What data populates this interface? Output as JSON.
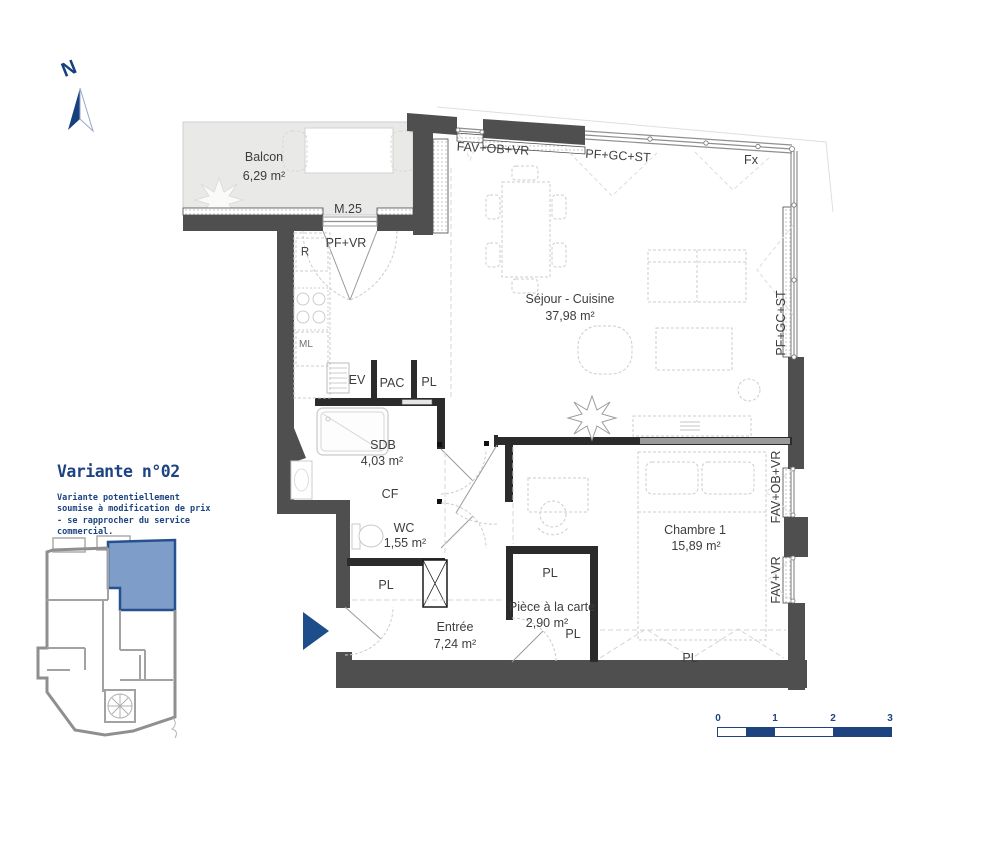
{
  "north": {
    "label": "N"
  },
  "variant": {
    "title": "Variante n°02",
    "disclaimer": "Variante potentiellement soumise à modification de prix - se rapprocher du service commercial."
  },
  "rooms": {
    "balcon": {
      "name": "Balcon",
      "area": "6,29 m²"
    },
    "sejour": {
      "name": "Séjour - Cuisine",
      "area": "37,98 m²"
    },
    "chambre1": {
      "name": "Chambre 1",
      "area": "15,89 m²"
    },
    "sdb": {
      "name": "SDB",
      "area": "4,03 m²"
    },
    "wc": {
      "name": "WC",
      "area": "1,55 m²"
    },
    "entree": {
      "name": "Entrée",
      "area": "7,24 m²"
    },
    "piece": {
      "name": "Pièce à la carte",
      "area": "2,90 m²"
    }
  },
  "annotations": {
    "m25": "M.25",
    "pf_vr": "PF+VR",
    "r": "R",
    "ml": "ML",
    "ev": "EV",
    "pac": "PAC",
    "pl_kitchen": "PL",
    "cf": "CF",
    "pl_wc": "PL",
    "pl_piece_top": "PL",
    "pl_piece_bottom": "PL",
    "pl_chambre": "PL",
    "fav_ob_vr_top": "FAV+OB+VR",
    "pf_gc_st_top": "PF+GC+ST",
    "fx": "Fx",
    "pf_gc_st_right": "PF+GC+ST",
    "fav_ob_vr_right": "FAV+OB+VR",
    "fav_vr_right": "FAV+VR"
  },
  "scale_bar": {
    "ticks": [
      "0",
      "1",
      "2",
      "3"
    ]
  },
  "colors": {
    "accent": "#1d4e89",
    "wall": "#4f4f4f",
    "balcony_fill": "#e9e9e8"
  }
}
